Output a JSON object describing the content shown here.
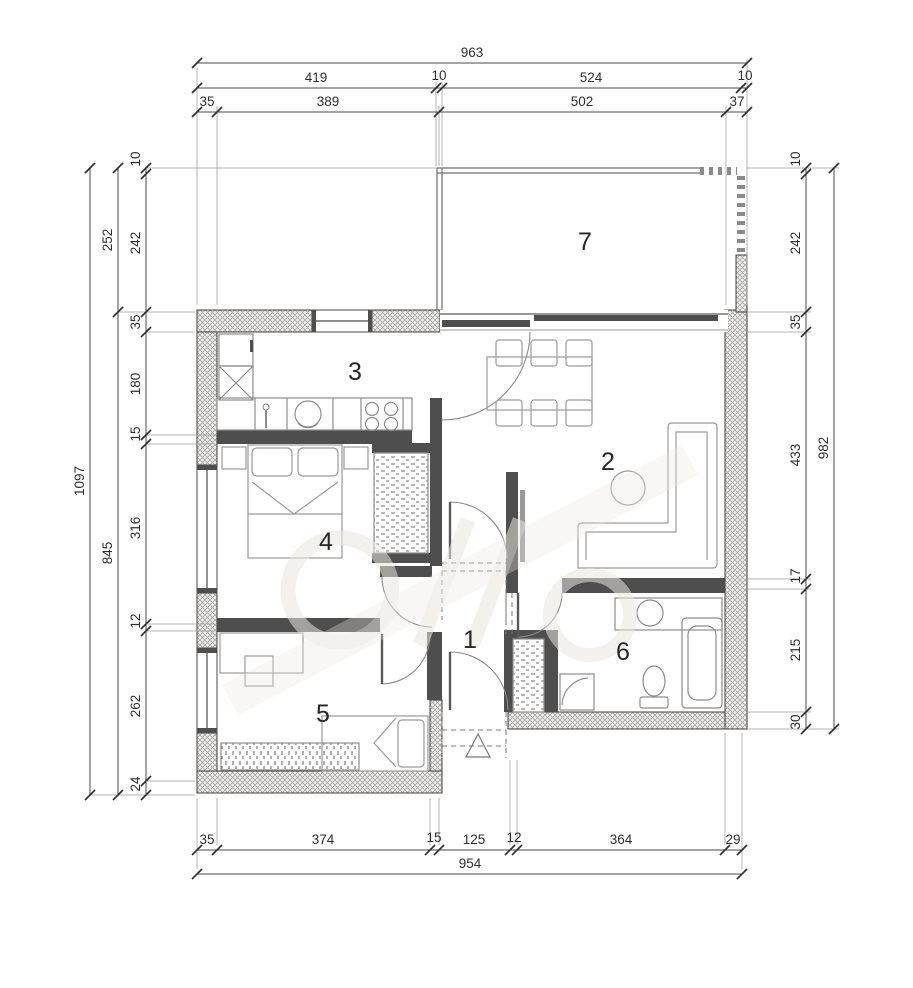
{
  "drawing": {
    "type": "apartment-floor-plan"
  },
  "rooms": {
    "r1": "1",
    "r2": "2",
    "r3": "3",
    "r4": "4",
    "r5": "5",
    "r6": "6",
    "r7": "7"
  },
  "dimensions": {
    "top": {
      "overall": "963",
      "row2": [
        "419",
        "10",
        "524",
        "10"
      ],
      "row3": [
        "35",
        "389",
        "502",
        "37"
      ]
    },
    "bottom": {
      "segments": [
        "35",
        "374",
        "15",
        "125",
        "12",
        "364",
        "29"
      ],
      "overall": "954"
    },
    "left": {
      "overall": "1097",
      "mid": [
        "252",
        "845"
      ],
      "segments": [
        "10",
        "242",
        "35",
        "180",
        "15",
        "316",
        "12",
        "262",
        "24"
      ]
    },
    "right": {
      "segments": [
        "10",
        "242",
        "35",
        "433",
        "17",
        "215",
        "30"
      ],
      "overall": "982"
    }
  },
  "colors": {
    "wall_hatch": "#a8a8a8",
    "interior_wall": "#4e4e4e",
    "furniture_line": "#8c8c8c",
    "dimension_line": "#4a4a4a"
  }
}
